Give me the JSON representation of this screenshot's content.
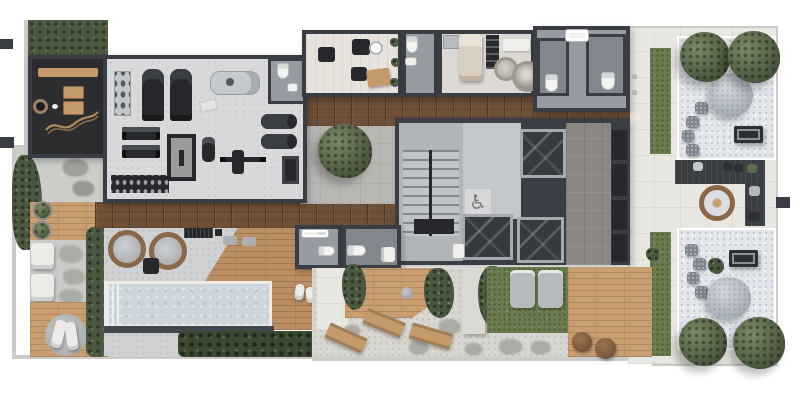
{
  "title": "residential-amenities-floor-plan-render",
  "icons": {
    "accessible_decal": "♿"
  },
  "areas": [
    "hedge-garden",
    "meditation-deck",
    "fitness-room",
    "gym-wc",
    "beauty-salon",
    "wc",
    "spa-treatment-room",
    "wc-stalls",
    "wood-corridor",
    "terrace-tree",
    "stairwell",
    "elevator-lobby",
    "elevators",
    "hallway",
    "service-shafts",
    "changing-wc-a",
    "changing-wc-b",
    "spa-tubs",
    "lap-pool",
    "pool-deck",
    "sun-lounger-patio",
    "round-daybed",
    "garden-dining",
    "grass-lounge",
    "timber-deck",
    "fire-pit-lounge",
    "zen-garden-upper",
    "zen-garden-lower",
    "lawn-strips",
    "paved-walkway"
  ],
  "colors": {
    "bg": "#ffffff",
    "wall": "#3a3e44",
    "wall-light": "#cbcbc7",
    "gym-floor": "#d7d9da",
    "dark-room": "#2c2d2f",
    "wood-corridor": "#6e5138",
    "wood-deck": "#bb8f63",
    "wood-deck-light": "#c99e71",
    "salon-floor": "#e7e3dc",
    "spa-floor": "#dcd9d4",
    "wc-floor": "#969ca2",
    "wc-floor-dark": "#81878d",
    "lobby-floor": "#c4c7c9",
    "stair-floor": "#b1b5b8",
    "hall-floor": "#8b8884",
    "pool-water": "#cdd5da",
    "pool-deck": "#cfd1d2",
    "paving": "#e9e7e2",
    "gravel-zen": "#e2e6eb",
    "gravel-garden": "#d8d6d0",
    "grass": "#697c4e",
    "hedge": "#4a5840",
    "planting": "#3b4931",
    "deck-dark": "#3b3e41",
    "equipment": "#26282b",
    "white-furniture": "#f0efec",
    "tan-furniture": "#c49a6a",
    "fire-rim": "#8a6746",
    "boulder": "#b7bdc3",
    "stone": "#acaca6",
    "massage-bed": "#d9cfc1"
  }
}
